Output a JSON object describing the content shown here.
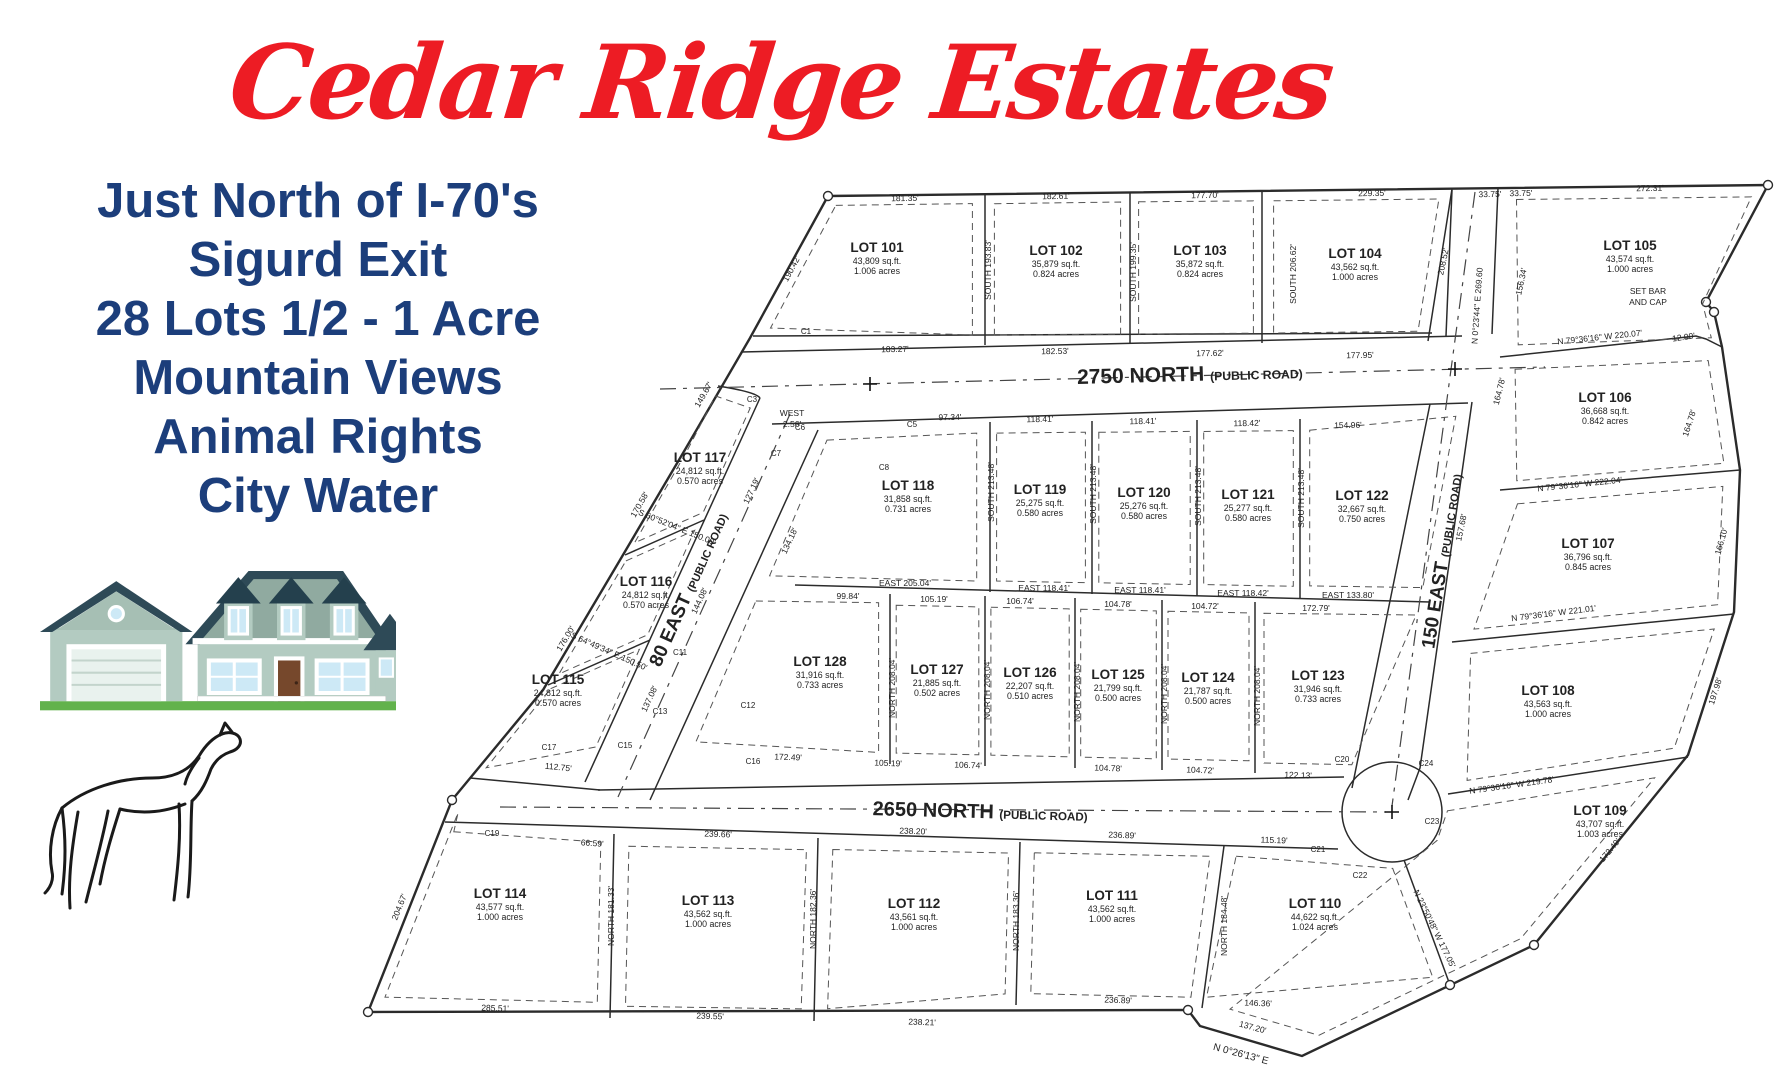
{
  "title": "Cedar Ridge Estates",
  "tagline": {
    "lines": [
      "Just North of I-70's",
      "Sigurd Exit",
      "28 Lots 1/2 - 1 Acre",
      "Mountain Views",
      "Animal Rights",
      "City Water"
    ]
  },
  "colors": {
    "title_red": "#ED1C24",
    "tagline_navy": "#1C3E7B",
    "map_ink": "#2b2b2b",
    "roof_slate": "#2e4a57",
    "wall_sage": "#b3cbc1",
    "window_blue": "#cde9f6",
    "door_brown": "#76482c",
    "grass_green": "#62b24c"
  },
  "map": {
    "roads": [
      {
        "label": "2750 NORTH",
        "sub": "(PUBLIC ROAD)"
      },
      {
        "label": "2650 NORTH",
        "sub": "(PUBLIC ROAD)"
      },
      {
        "label": "80 EAST",
        "sub": "(PUBLIC ROAD)"
      },
      {
        "label": "150 EAST",
        "sub": "(PUBLIC ROAD)"
      }
    ],
    "lots": [
      {
        "name": "LOT 101",
        "sqft": "43,809 sq.ft.",
        "acres": "1.006 acres"
      },
      {
        "name": "LOT 102",
        "sqft": "35,879 sq.ft.",
        "acres": "0.824 acres"
      },
      {
        "name": "LOT 103",
        "sqft": "35,872 sq.ft.",
        "acres": "0.824 acres"
      },
      {
        "name": "LOT 104",
        "sqft": "43,562 sq.ft.",
        "acres": "1.000 acres"
      },
      {
        "name": "LOT 105",
        "sqft": "43,574 sq.ft.",
        "acres": "1.000 acres"
      },
      {
        "name": "LOT 106",
        "sqft": "36,668 sq.ft.",
        "acres": "0.842 acres"
      },
      {
        "name": "LOT 107",
        "sqft": "36,796 sq.ft.",
        "acres": "0.845 acres"
      },
      {
        "name": "LOT 108",
        "sqft": "43,563 sq.ft.",
        "acres": "1.000 acres"
      },
      {
        "name": "LOT 109",
        "sqft": "43,707 sq.ft.",
        "acres": "1.003 acres"
      },
      {
        "name": "LOT 110",
        "sqft": "44,622 sq.ft.",
        "acres": "1.024 acres"
      },
      {
        "name": "LOT 111",
        "sqft": "43,562 sq.ft.",
        "acres": "1.000 acres"
      },
      {
        "name": "LOT 112",
        "sqft": "43,561 sq.ft.",
        "acres": "1.000 acres"
      },
      {
        "name": "LOT 113",
        "sqft": "43,562 sq.ft.",
        "acres": "1.000 acres"
      },
      {
        "name": "LOT 114",
        "sqft": "43,577 sq.ft.",
        "acres": "1.000 acres"
      },
      {
        "name": "LOT 115",
        "sqft": "24,812 sq.ft.",
        "acres": "0.570 acres"
      },
      {
        "name": "LOT 116",
        "sqft": "24,812 sq.ft.",
        "acres": "0.570 acres"
      },
      {
        "name": "LOT 117",
        "sqft": "24,812 sq.ft.",
        "acres": "0.570 acres"
      },
      {
        "name": "LOT 118",
        "sqft": "31,858 sq.ft.",
        "acres": "0.731 acres"
      },
      {
        "name": "LOT 119",
        "sqft": "25,275 sq.ft.",
        "acres": "0.580 acres"
      },
      {
        "name": "LOT 120",
        "sqft": "25,276 sq.ft.",
        "acres": "0.580 acres"
      },
      {
        "name": "LOT 121",
        "sqft": "25,277 sq.ft.",
        "acres": "0.580 acres"
      },
      {
        "name": "LOT 122",
        "sqft": "32,667 sq.ft.",
        "acres": "0.750 acres"
      },
      {
        "name": "LOT 123",
        "sqft": "31,946 sq.ft.",
        "acres": "0.733 acres"
      },
      {
        "name": "LOT 124",
        "sqft": "21,787 sq.ft.",
        "acres": "0.500 acres"
      },
      {
        "name": "LOT 125",
        "sqft": "21,799 sq.ft.",
        "acres": "0.500 acres"
      },
      {
        "name": "LOT 126",
        "sqft": "22,207 sq.ft.",
        "acres": "0.510 acres"
      },
      {
        "name": "LOT 127",
        "sqft": "21,885 sq.ft.",
        "acres": "0.502 acres"
      },
      {
        "name": "LOT 128",
        "sqft": "31,916 sq.ft.",
        "acres": "0.733 acres"
      }
    ],
    "dimensions": [
      "181.35'",
      "182.61'",
      "177.70'",
      "229.35'",
      "33.75'",
      "33.75'",
      "272.31'",
      "183.27'",
      "182.53'",
      "177.62'",
      "177.95'",
      "SOUTH  193.83'",
      "SOUTH  199.35'",
      "SOUTH  206.62'",
      "208.52'",
      "190.42'",
      "156.34'",
      "N 0°23'44\" E  269.60",
      "SET BAR",
      "AND CAP",
      "12.90'",
      "N 79°36'16\" W  220.07'",
      "164.78'",
      "164.78'",
      "N 79°36'16\" W  222.04'",
      "157.68'",
      "166.10'",
      "N 79°36'16\" W  221.01'",
      "197.98'",
      "N 79°36'16\" W  219.78'",
      "172.49'",
      "97.34'",
      "118.41'",
      "118.41'",
      "118.42'",
      "154.96'",
      "SOUTH  213.48'",
      "SOUTH  213.48'",
      "SOUTH  213.48'",
      "SOUTH  213.48'",
      "EAST  205.04'",
      "EAST  118.41'",
      "EAST  118.41'",
      "EAST  118.42'",
      "EAST  133.80'",
      "99.84'",
      "105.19'",
      "106.74'",
      "104.78'",
      "104.72'",
      "172.79'",
      "NORTH  208.04'",
      "NORTH  208.04'",
      "NORTH  208.04'",
      "NORTH  208.04'",
      "NORTH  208.04'",
      "172.49'",
      "105.19'",
      "106.74'",
      "104.78'",
      "104.72'",
      "122.13'",
      "WEST",
      "2.56'",
      "S 60°52'04\" E  150.00'",
      "S 64°49'34\" E  150.50'",
      "149.67'",
      "170.58'",
      "176.00'",
      "204.67'",
      "127.19'",
      "144.08'",
      "137.08'",
      "134.18'",
      "112.75'",
      "66.59'",
      "239.66'",
      "238.20'",
      "236.89'",
      "115.19'",
      "285.51'",
      "239.55'",
      "238.21'",
      "236.89'",
      "146.36'",
      "NORTH  181.33'",
      "NORTH  182.36'",
      "NORTH  183.36'",
      "NORTH  184.48'",
      "N 23°50'48\" W  177.05'",
      "137.20'",
      "N 0°26'13\" E",
      "C1",
      "C3",
      "C5",
      "C6",
      "C7",
      "C8",
      "C11",
      "C12",
      "C13",
      "C15",
      "C16",
      "C17",
      "C19",
      "C20",
      "C21",
      "C22",
      "C23",
      "C24"
    ]
  }
}
